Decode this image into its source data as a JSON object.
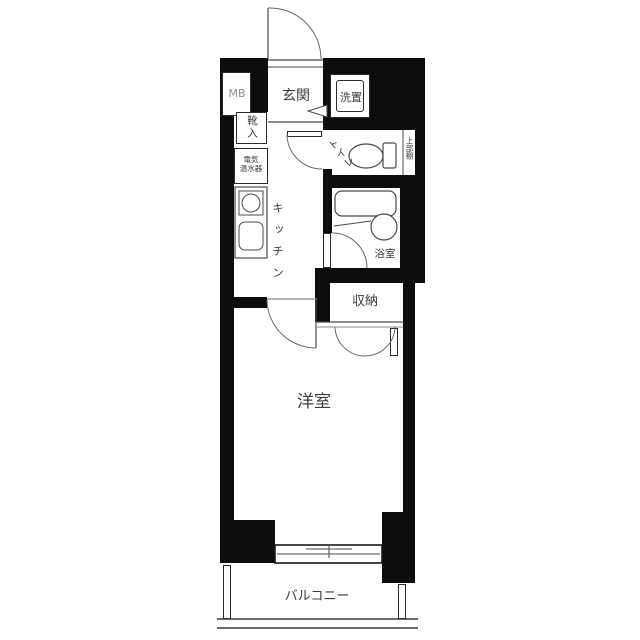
{
  "plan": {
    "labels": {
      "meter_box": "MB",
      "entrance": "玄関",
      "washer_space": "洗置",
      "shoe_cabinet": "靴入",
      "water_heater_line1": "電気",
      "water_heater_line2": "温水器",
      "kitchen": "キッチン",
      "toilet": "トイレ",
      "upper_shelf": "上部棚",
      "bathroom": "浴室",
      "storage": "収納",
      "western_room": "洋室",
      "balcony": "バルコニー"
    },
    "colors": {
      "wall": "#0d0d0d",
      "line": "#4a4a4a",
      "text": "#3c3c3c",
      "meter_box_text": "#8f8f8f"
    }
  }
}
